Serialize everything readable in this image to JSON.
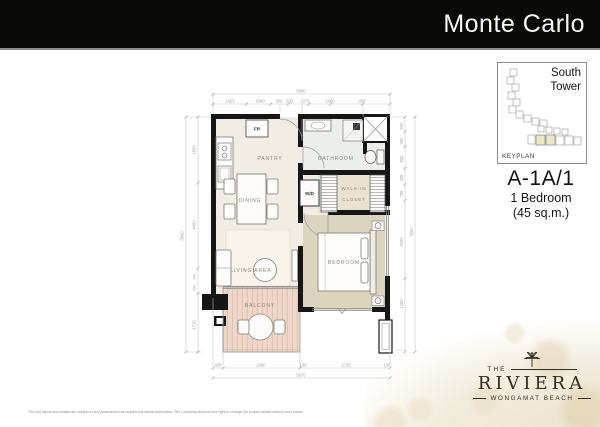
{
  "banner": {
    "title": "Monte Carlo"
  },
  "keyplan": {
    "tower": "South Tower",
    "label": "KEYPLAN"
  },
  "unit": {
    "code": "A-1A/1",
    "type": "1 Bedroom",
    "area": "(45 sq.m.)"
  },
  "floorplan": {
    "labels": {
      "pantry": "PANTRY",
      "bathroom": "BATHROOM",
      "dining": "DINING",
      "living": "LIVING AREA",
      "bedroom": "BEDROOM",
      "balcony": "BALCONY",
      "closet_line1": "WALK-IN",
      "closet_line2": "CLOSET",
      "washer": "W/D",
      "fridge": "FR"
    },
    "dims": {
      "top_total": "5800",
      "top": [
        "1425",
        "1000",
        "500",
        "200",
        "1075",
        "1000",
        "450"
      ],
      "left_total": "8600",
      "left": [
        "1850",
        "4450",
        "400",
        "200",
        "1715"
      ],
      "right_total": "7000",
      "right": [
        "500",
        "300",
        "800",
        "400",
        "700",
        "2400",
        "1400"
      ],
      "bottom_total": "5675",
      "bottom": [
        "400",
        "2450",
        "100",
        "2725",
        "100"
      ]
    }
  },
  "logo": {
    "the": "THE",
    "name": "RIVIERA",
    "tagline": "WONGAMAT BEACH"
  },
  "disclaimer": "The unit layout and details are subject to any amendment as required by official authorities. The Company reserves the right to change the project details without prior notice.",
  "colors": {
    "banner_bg": "#0a0a08",
    "wall": "#161616",
    "unit_floor": "#f2ede4",
    "bedroom_floor": "#dbd5c0",
    "balcony_wood": "#efd8c9",
    "keyplan_highlight": "#ebe7c3",
    "bokeh": "#ece3cf"
  }
}
